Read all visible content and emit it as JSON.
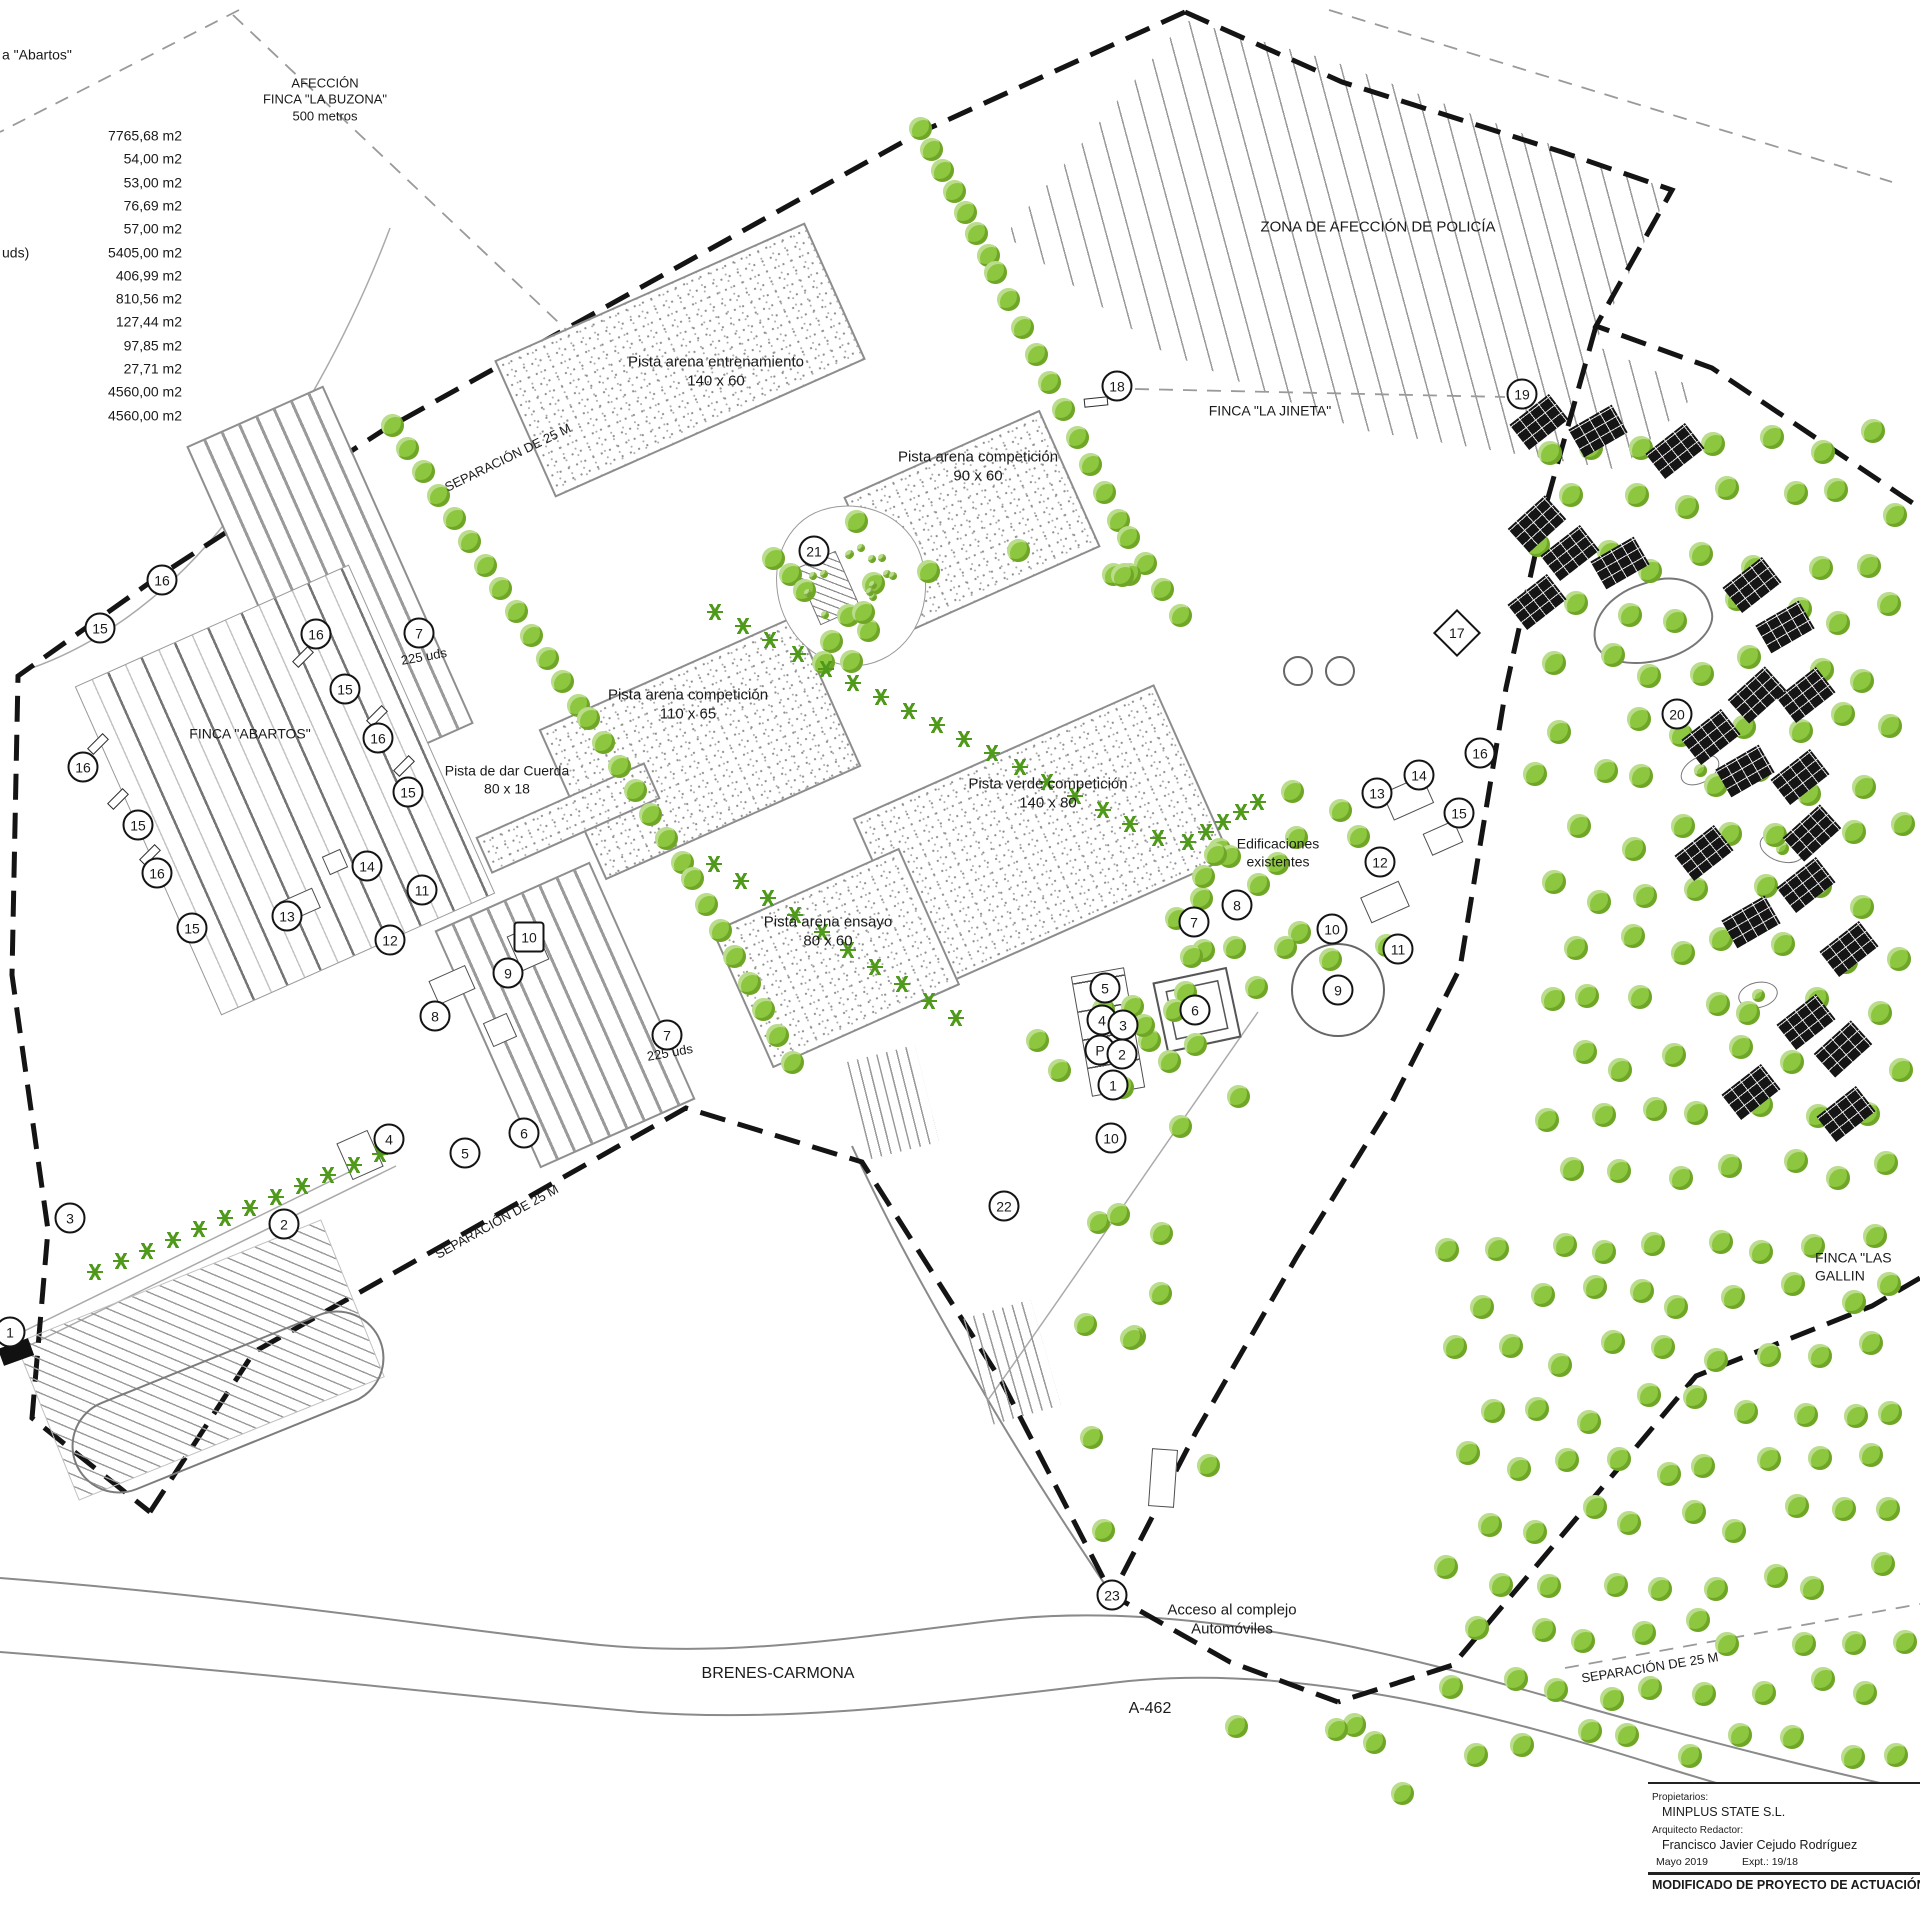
{
  "area_table": {
    "partial_heading": "a \"Abartos\"",
    "partial_row_label": "uds)",
    "values": [
      "7765,68 m2",
      "54,00 m2",
      "53,00 m2",
      "76,69 m2",
      "57,00 m2",
      "5405,00 m2",
      "406,99 m2",
      "810,56 m2",
      "127,44 m2",
      "97,85 m2",
      "27,71 m2",
      "4560,00 m2",
      "4560,00 m2"
    ]
  },
  "title_block": {
    "propietarios_label": "Propietarios:",
    "propietarios": "MINPLUS STATE S.L.",
    "arquitecto_label": "Arquitecto Redactor:",
    "arquitecto": "Francisco Javier Cejudo Rodríguez",
    "fecha": "Mayo  2019",
    "expediente": "Expt.:  19/18",
    "proyecto": "MODIFICADO DE PROYECTO DE ACTUACIÓN"
  },
  "labels": [
    [
      "AFECCIÓN\nFINCA \"LA BUZONA\"\n500 metros",
      325,
      100,
      0,
      13,
      "c"
    ],
    [
      "ZONA DE AFECCIÓN DE POLICÍA",
      1378,
      228,
      0,
      15,
      "c"
    ],
    [
      "FINCA \"LA JINETA\"",
      1270,
      411,
      0,
      14,
      "c"
    ],
    [
      "FINCA \"ABARTOS\"",
      250,
      734,
      0,
      14,
      "c"
    ],
    [
      "FINCA \"LAS GALLIN",
      1815,
      1267,
      0,
      14,
      "l"
    ],
    [
      "SEPARACIÓN DE 25 M",
      508,
      458,
      -26,
      13,
      "c"
    ],
    [
      "SEPARACIÓN DE 25 M",
      497,
      1222,
      -29,
      13,
      "c"
    ],
    [
      "SEPARACIÓN DE 25 M",
      1650,
      1668,
      -9,
      13,
      "c"
    ],
    [
      "Pista arena entrenamiento\n140 x 60",
      716,
      372,
      0,
      15,
      "c"
    ],
    [
      "Pista arena competición\n90 x 60",
      978,
      467,
      0,
      15,
      "c"
    ],
    [
      "Pista arena competición\n110 x 65",
      688,
      705,
      0,
      15,
      "c"
    ],
    [
      "Pista verde competición\n140 x 80",
      1048,
      794,
      0,
      15,
      "c"
    ],
    [
      "Pista arena ensayo\n80 x 60",
      828,
      932,
      0,
      15,
      "c"
    ],
    [
      "Pista de dar Cuerda\n80 x 18",
      507,
      780,
      0,
      14,
      "c"
    ],
    [
      "225 uds",
      424,
      657,
      -10,
      13,
      "c"
    ],
    [
      "225 uds",
      670,
      1053,
      -10,
      13,
      "c"
    ],
    [
      "Edificaciones\nexistentes",
      1278,
      853,
      0,
      14,
      "c"
    ],
    [
      "Acceso al complejo\nAutomóviles",
      1232,
      1620,
      0,
      15,
      "c"
    ],
    [
      "BRENES-CARMONA",
      778,
      1674,
      0,
      16,
      "c"
    ],
    [
      "A-462",
      1150,
      1709,
      0,
      16,
      "c"
    ],
    [
      "a \"Abartos\"",
      2,
      55,
      0,
      14,
      "l"
    ],
    [
      "uds)",
      2,
      253,
      0,
      14,
      "l"
    ]
  ],
  "markers": [
    [
      "16",
      162,
      580
    ],
    [
      "15",
      100,
      628
    ],
    [
      "16",
      316,
      634
    ],
    [
      "15",
      345,
      689
    ],
    [
      "16",
      378,
      738
    ],
    [
      "15",
      408,
      792
    ],
    [
      "16",
      83,
      767
    ],
    [
      "15",
      138,
      825
    ],
    [
      "16",
      157,
      873
    ],
    [
      "15",
      192,
      928
    ],
    [
      "13",
      287,
      916
    ],
    [
      "14",
      367,
      866
    ],
    [
      "12",
      390,
      940
    ],
    [
      "11",
      422,
      890
    ],
    [
      "10",
      529,
      937,
      "b"
    ],
    [
      "9",
      508,
      973
    ],
    [
      "8",
      435,
      1016
    ],
    [
      "7",
      419,
      633
    ],
    [
      "7",
      667,
      1035
    ],
    [
      "6",
      524,
      1133
    ],
    [
      "5",
      465,
      1153
    ],
    [
      "4",
      389,
      1139
    ],
    [
      "3",
      70,
      1218
    ],
    [
      "2",
      284,
      1224
    ],
    [
      "1",
      10,
      1332
    ],
    [
      "5",
      1105,
      988
    ],
    [
      "4",
      1102,
      1020
    ],
    [
      "3",
      1123,
      1025
    ],
    [
      "P",
      1100,
      1050
    ],
    [
      "2",
      1122,
      1054
    ],
    [
      "1",
      1113,
      1085
    ],
    [
      "10",
      1111,
      1138
    ],
    [
      "6",
      1195,
      1010
    ],
    [
      "9",
      1338,
      990
    ],
    [
      "7",
      1194,
      922
    ],
    [
      "8",
      1237,
      905
    ],
    [
      "10",
      1332,
      929
    ],
    [
      "11",
      1398,
      949
    ],
    [
      "12",
      1380,
      862
    ],
    [
      "13",
      1377,
      793
    ],
    [
      "14",
      1419,
      775
    ],
    [
      "15",
      1459,
      813
    ],
    [
      "16",
      1480,
      753
    ],
    [
      "17",
      1457,
      633,
      "d"
    ],
    [
      "18",
      1117,
      386
    ],
    [
      "19",
      1522,
      394
    ],
    [
      "20",
      1677,
      714
    ],
    [
      "21",
      814,
      551
    ],
    [
      "22",
      1004,
      1206
    ],
    [
      "23",
      1112,
      1595
    ]
  ],
  "boxes": [
    [
      "pista",
      680,
      360,
      340,
      150,
      -24
    ],
    [
      "pista",
      972,
      522,
      215,
      150,
      -24
    ],
    [
      "pista",
      700,
      748,
      280,
      165,
      -24
    ],
    [
      "pista",
      1042,
      838,
      330,
      190,
      -24
    ],
    [
      "pista",
      836,
      958,
      205,
      150,
      -24
    ],
    [
      "pista",
      568,
      818,
      185,
      40,
      -24
    ],
    [
      "stall",
      330,
      585,
      150,
      370,
      -24
    ],
    [
      "stall",
      565,
      1015,
      170,
      260,
      -24
    ],
    [
      "field",
      285,
      790,
      300,
      360,
      -24
    ],
    [
      "hatch",
      200,
      1360,
      330,
      170,
      -22
    ],
    [
      "oval",
      228,
      1402,
      330,
      95,
      -22
    ],
    [
      "bb",
      1539,
      422,
      50,
      32,
      -38
    ],
    [
      "bb",
      1598,
      431,
      50,
      32,
      -30
    ],
    [
      "bb",
      1675,
      451,
      50,
      32,
      -38
    ],
    [
      "bb",
      1537,
      524,
      50,
      32,
      -42
    ],
    [
      "bb",
      1570,
      553,
      50,
      32,
      -38
    ],
    [
      "bb",
      1620,
      563,
      50,
      32,
      -30
    ],
    [
      "bb",
      1537,
      602,
      50,
      32,
      -38
    ],
    [
      "bb",
      1752,
      585,
      50,
      32,
      -38
    ],
    [
      "bb",
      1785,
      627,
      50,
      32,
      -30
    ],
    [
      "bb",
      1757,
      695,
      50,
      32,
      -42
    ],
    [
      "bb",
      1806,
      695,
      50,
      32,
      -38
    ],
    [
      "bb",
      1711,
      737,
      50,
      32,
      -38
    ],
    [
      "bb",
      1745,
      771,
      50,
      32,
      -30
    ],
    [
      "bb",
      1800,
      777,
      50,
      32,
      -38
    ],
    [
      "bb",
      1812,
      833,
      50,
      32,
      -42
    ],
    [
      "bb",
      1704,
      853,
      50,
      32,
      -38
    ],
    [
      "bb",
      1806,
      885,
      50,
      32,
      -38
    ],
    [
      "bb",
      1751,
      922,
      50,
      32,
      -30
    ],
    [
      "bb",
      1849,
      949,
      50,
      32,
      -38
    ],
    [
      "bb",
      1806,
      1022,
      50,
      32,
      -38
    ],
    [
      "bb",
      1843,
      1049,
      50,
      32,
      -42
    ],
    [
      "bb",
      1751,
      1092,
      50,
      32,
      -38
    ],
    [
      "bb",
      1846,
      1114,
      50,
      32,
      -38
    ],
    [
      "out",
      1408,
      798,
      44,
      30,
      -24
    ],
    [
      "out",
      1443,
      838,
      34,
      24,
      -24
    ],
    [
      "out",
      1385,
      902,
      42,
      28,
      -24
    ],
    [
      "out",
      1163,
      1478,
      26,
      58,
      4
    ],
    [
      "out",
      528,
      948,
      30,
      38,
      -24
    ],
    [
      "out",
      452,
      985,
      40,
      26,
      -24
    ],
    [
      "out",
      500,
      1030,
      26,
      26,
      -24
    ],
    [
      "out",
      360,
      1155,
      34,
      40,
      -24
    ],
    [
      "out",
      300,
      905,
      36,
      22,
      -24
    ],
    [
      "out",
      335,
      862,
      20,
      20,
      -24
    ],
    [
      "cb",
      1108,
      1032,
      54,
      122,
      -10
    ],
    [
      "sq6",
      1197,
      1010,
      76,
      72,
      -12
    ],
    [
      "circ",
      1338,
      990,
      94,
      94,
      0
    ],
    [
      "circ",
      1298,
      671,
      30,
      30,
      0
    ],
    [
      "circ",
      1340,
      671,
      30,
      30,
      0
    ],
    [
      "pond",
      1652,
      622,
      122,
      80,
      -18
    ],
    [
      "bean",
      1700,
      770,
      42,
      26,
      -30
    ],
    [
      "bean",
      1782,
      848,
      46,
      28,
      18
    ],
    [
      "bean",
      1758,
      995,
      40,
      26,
      -12
    ],
    [
      "plaza",
      852,
      585,
      150,
      162,
      -18
    ],
    [
      "hatchb",
      828,
      588,
      44,
      62,
      -24
    ],
    [
      "bar",
      118,
      799,
      22,
      9,
      -45
    ],
    [
      "bar",
      377,
      716,
      22,
      9,
      -45
    ],
    [
      "bar",
      404,
      766,
      22,
      9,
      -45
    ],
    [
      "bar",
      303,
      657,
      22,
      9,
      -45
    ],
    [
      "bar",
      150,
      855,
      22,
      9,
      -45
    ],
    [
      "bar",
      98,
      744,
      22,
      9,
      -45
    ],
    [
      "bar",
      1548,
      415,
      26,
      10,
      -6
    ],
    [
      "bar",
      1096,
      402,
      24,
      9,
      -6
    ],
    [
      "comb",
      893,
      1102,
      70,
      100,
      -14
    ],
    [
      "comb",
      1012,
      1362,
      70,
      110,
      -16
    ],
    [
      "bks",
      16,
      1352,
      32,
      18,
      -20
    ]
  ],
  "vegetation": {
    "tree_rows": [
      [
        920,
        128,
        988,
        255,
        7,
        23
      ],
      [
        995,
        272,
        1118,
        520,
        10,
        23
      ],
      [
        1128,
        537,
        1180,
        615,
        4,
        23
      ],
      [
        392,
        425,
        578,
        705,
        13,
        23
      ],
      [
        588,
        718,
        682,
        862,
        7,
        23
      ],
      [
        692,
        878,
        792,
        1062,
        8,
        23
      ],
      [
        1700,
        770,
        1700,
        770,
        1,
        13
      ],
      [
        1782,
        848,
        1782,
        848,
        1,
        13
      ],
      [
        1758,
        995,
        1758,
        995,
        1,
        13
      ]
    ],
    "tree_clusters": [
      [
        850,
        582,
        95,
        85,
        12,
        23,
        7
      ],
      [
        1300,
        905,
        135,
        115,
        20,
        23,
        11
      ],
      [
        1145,
        1048,
        110,
        95,
        13,
        23,
        23
      ],
      [
        1135,
        1380,
        85,
        195,
        10,
        23,
        31
      ],
      [
        1300,
        1770,
        130,
        80,
        6,
        23,
        41
      ],
      [
        1075,
        560,
        60,
        40,
        5,
        23,
        53
      ],
      [
        852,
        590,
        48,
        55,
        14,
        8,
        61
      ]
    ],
    "tree_grids": [
      [
        1545,
        445,
        7,
        14,
        54,
        56,
        14,
        24,
        5
      ],
      [
        1455,
        1240,
        9,
        10,
        52,
        56,
        14,
        24,
        9
      ]
    ],
    "star_rows": [
      [
        715,
        612,
        1158,
        838,
        17
      ],
      [
        714,
        864,
        956,
        1018,
        10
      ],
      [
        95,
        1272,
        380,
        1154,
        12
      ],
      [
        1188,
        842,
        1258,
        802,
        5
      ]
    ]
  },
  "colors": {
    "tree_green": "#8dc63f",
    "star_green": "#4f9a1a",
    "line_black": "#141414",
    "line_gray": "#8d8d8d"
  }
}
